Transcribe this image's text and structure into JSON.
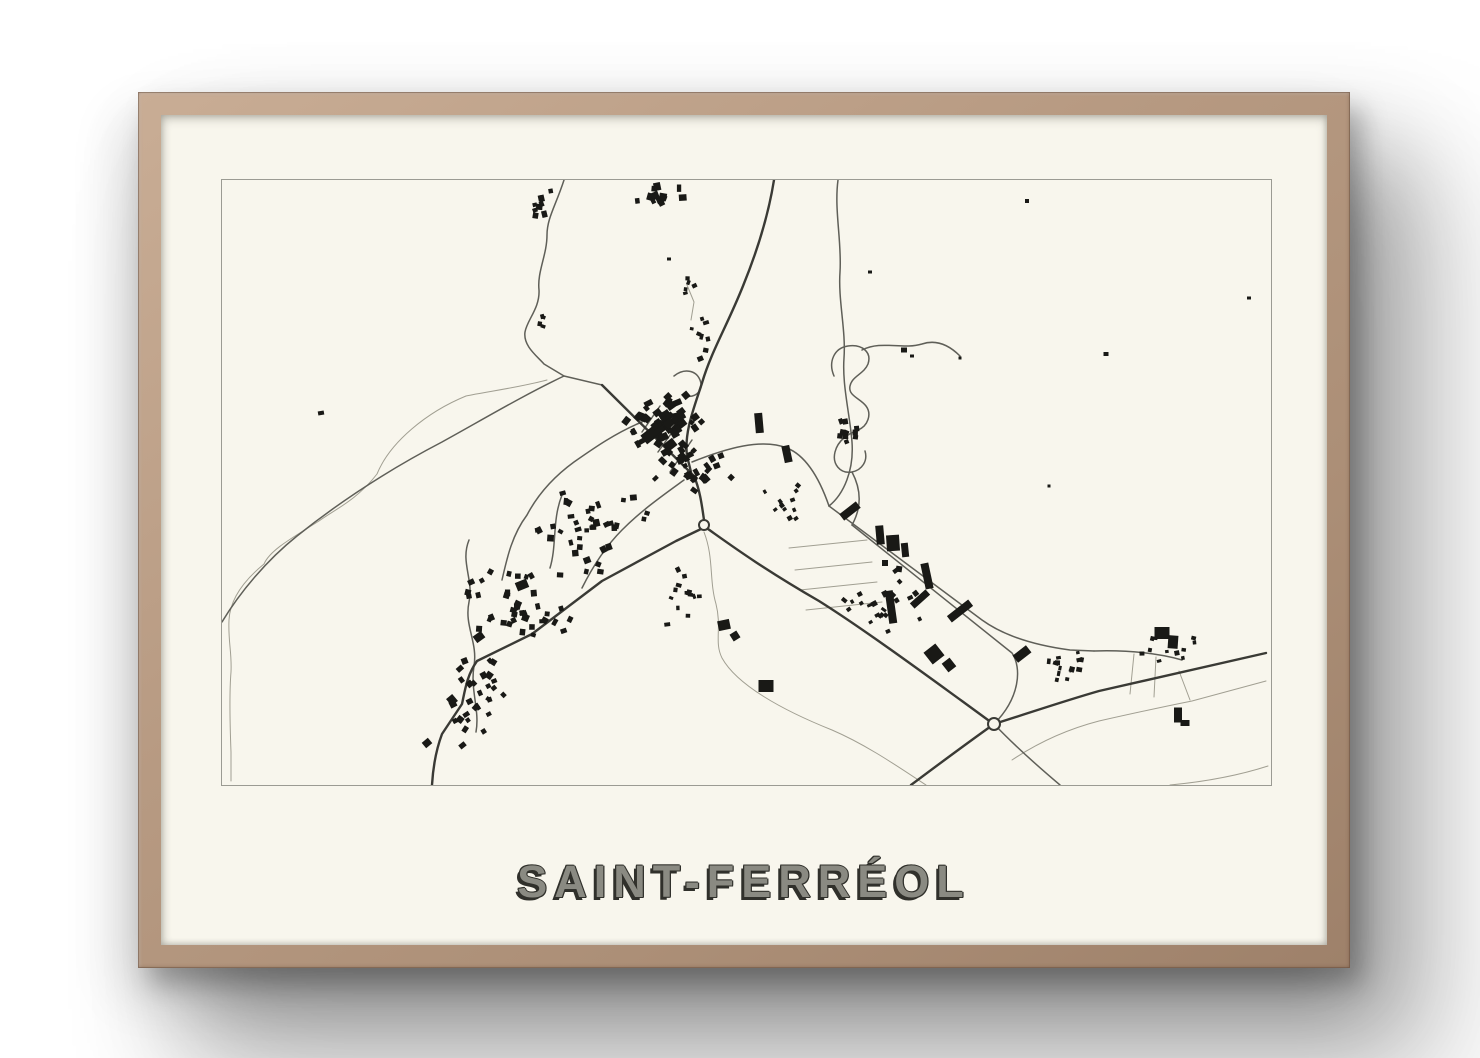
{
  "artwork": {
    "title": "SAINT-FERRÉOL",
    "type_label": "framed town map poster"
  },
  "frame": {
    "wood_light": "#c9ad95",
    "wood_mid": "#b2957e",
    "wood_dark": "#9e816a",
    "wall_color": "#ffffff"
  },
  "poster": {
    "paper_color": "#f8f6ed",
    "border_color": "#9b9b93",
    "ink_color": "#191916",
    "title_face_color": "#8a8a82",
    "title_shadow_color": "#30302b"
  },
  "map": {
    "place_name": "Saint-Ferréol",
    "road_styles": {
      "major": {
        "color": "#3a3a35",
        "width": 2.4
      },
      "minor": {
        "color": "#5f5f58",
        "width": 1.5
      },
      "trail": {
        "color": "#a19f92",
        "width": 1
      }
    },
    "roads": {
      "major": [
        "M552,0 C546,38 534,74 521,106 C505,146 489,172 480,203 C472,228 462,252 465,276 L469,292",
        "M380,205 L472,296 C478,310 480,326 482,340",
        "M479,349 L454,361 L380,401 L310,454 L255,481 C245,495 243,510 240,524 L220,554 C214,570 211,588 210,605",
        "M486,349 C510,366 540,388 597,421 C640,448 700,492 740,521 L766,540",
        "M689,605 C717,584 744,564 772,544 C807,533 842,521 877,511 C932,499 988,486 1044,473"
      ],
      "minor": [
        "M342,0 C334,25 325,38 325,55 C325,75 315,92 317,110 C318,128 305,140 303,152 C301,166 315,176 322,184 L342,196 L380,205",
        "M616,0 C612,30 620,62 618,92 C616,120 624,150 622,178 C620,205 628,235 630,262 C632,290 622,314 607,326",
        "M607,326 L760,440 C785,458 818,466 848,470 L872,471",
        "M630,345 L790,473 C800,488 798,518 772,544",
        "M470,282 C505,268 540,258 565,268 C585,276 598,300 607,326",
        "M612,196 C606,182 612,168 626,166 C640,164 650,172 646,184 C642,194 630,196 628,206 C626,216 638,218 644,226 C650,234 646,246 636,250 C626,254 616,260 613,272 C610,284 618,294 630,292 C640,290 646,281 643,271",
        "M630,292 C639,309 640,327 630,345",
        "M640,170 C660,160 680,170 700,164 C715,159 728,166 738,176",
        "M342,196 C300,216 260,240 220,262 C170,288 120,320 75,356 C45,380 18,412 0,442",
        "M420,242 C395,252 372,268 352,282 C330,298 315,316 305,335 C290,355 285,378 280,400",
        "M247,360 C238,382 252,400 247,422 C242,446 256,462 252,486 C248,510 258,530 254,552",
        "M340,315 C330,340 335,365 328,388",
        "M438,226 L420,252",
        "M456,244 L436,272",
        "M470,260 L448,292",
        "M452,196 C462,188 474,190 478,200 C482,210 474,218 464,216",
        "M462,300 C440,316 420,330 400,350 C382,368 370,388 360,408",
        "M772,544 C790,563 812,583 838,605",
        "M872,471 C905,470 935,473 960,480"
      ],
      "trail": [
        "M325,200 C295,208 262,212 244,216 C205,232 168,262 155,294 C135,320 112,330 97,341 C70,358 48,370 42,384 C20,402 8,420 7,440 C6,462 10,472 9,492 C7,516 8,546 9,572 L9,601",
        "M482,352 C492,378 487,400 494,424 C500,448 492,462 500,478 C515,505 560,530 610,550 C645,565 678,588 704,605",
        "M567,368 L645,360",
        "M573,390 L650,382",
        "M578,410 L655,402",
        "M584,430 L660,422",
        "M1046,586 C1015,596 980,602 948,605",
        "M790,580 C820,560 850,548 877,541 C908,534 940,527 970,521 L1044,501",
        "M957,491 L968,520",
        "M912,474 L908,514",
        "M934,477 L932,517",
        "M465,105 L472,122 L469,140"
      ]
    },
    "roundabouts": [
      [
        482,
        345,
        5
      ],
      [
        772,
        544,
        6
      ]
    ],
    "buildings_large": [
      [
        432,
        252,
        26,
        11,
        -38
      ],
      [
        448,
        265,
        12,
        9,
        -38
      ],
      [
        456,
        240,
        9,
        15,
        -12
      ],
      [
        420,
        237,
        10,
        8,
        22
      ],
      [
        537,
        243,
        8,
        20,
        -5
      ],
      [
        565,
        274,
        8,
        17,
        -12
      ],
      [
        628,
        331,
        21,
        8,
        -38
      ],
      [
        658,
        355,
        8,
        19,
        -5
      ],
      [
        671,
        363,
        13,
        16,
        -4
      ],
      [
        683,
        370,
        7,
        14,
        -6
      ],
      [
        663,
        383,
        6,
        6,
        0
      ],
      [
        677,
        389,
        6,
        6,
        8
      ],
      [
        705,
        396,
        8,
        26,
        -12
      ],
      [
        698,
        419,
        21,
        7,
        -42
      ],
      [
        738,
        431,
        27,
        8,
        -38
      ],
      [
        669,
        427,
        8,
        33,
        -8
      ],
      [
        712,
        474,
        15,
        15,
        -38
      ],
      [
        727,
        485,
        10,
        11,
        -38
      ],
      [
        800,
        474,
        17,
        9,
        -38
      ],
      [
        940,
        453,
        15,
        12,
        0
      ],
      [
        951,
        462,
        10,
        13,
        4
      ],
      [
        956,
        535,
        8,
        15,
        0
      ],
      [
        963,
        543,
        9,
        6,
        0
      ],
      [
        502,
        445,
        12,
        10,
        -12
      ],
      [
        513,
        456,
        8,
        8,
        -32
      ],
      [
        544,
        506,
        15,
        12,
        0
      ],
      [
        300,
        405,
        12,
        9,
        -22
      ],
      [
        257,
        457,
        10,
        8,
        -36
      ],
      [
        230,
        520,
        8,
        9,
        -40
      ],
      [
        205,
        563,
        8,
        7,
        -40
      ]
    ],
    "buildings_single": [
      [
        99,
        233,
        6,
        4,
        -10
      ],
      [
        682,
        170,
        6,
        5,
        0
      ],
      [
        805,
        21,
        4,
        4,
        0
      ],
      [
        884,
        174,
        5,
        4,
        0
      ],
      [
        1027,
        118,
        4,
        3,
        0
      ],
      [
        827,
        306,
        3,
        3,
        0
      ],
      [
        738,
        178,
        3,
        3,
        0
      ],
      [
        690,
        176,
        4,
        3,
        0
      ],
      [
        648,
        92,
        4,
        3,
        0
      ],
      [
        447,
        79,
        4,
        3,
        0
      ]
    ],
    "building_clusters": [
      {
        "cx": 437,
        "cy": 17,
        "rx": 30,
        "ry": 15,
        "count": 13,
        "min": 4,
        "max": 8,
        "angle": 0,
        "jitter": 60,
        "seed": 11
      },
      {
        "cx": 322,
        "cy": 32,
        "rx": 16,
        "ry": 24,
        "count": 9,
        "min": 4,
        "max": 7,
        "angle": -10,
        "jitter": 50,
        "seed": 22
      },
      {
        "cx": 318,
        "cy": 142,
        "rx": 8,
        "ry": 15,
        "count": 4,
        "min": 3,
        "max": 5,
        "angle": 0,
        "jitter": 60,
        "seed": 33
      },
      {
        "cx": 443,
        "cy": 243,
        "rx": 46,
        "ry": 36,
        "count": 42,
        "min": 4,
        "max": 9,
        "angle": -38,
        "jitter": 30,
        "seed": 44
      },
      {
        "cx": 468,
        "cy": 288,
        "rx": 44,
        "ry": 28,
        "count": 30,
        "min": 4,
        "max": 8,
        "angle": -38,
        "jitter": 35,
        "seed": 55
      },
      {
        "cx": 373,
        "cy": 352,
        "rx": 66,
        "ry": 42,
        "count": 38,
        "min": 4,
        "max": 7,
        "angle": 0,
        "jitter": 60,
        "seed": 66
      },
      {
        "cx": 303,
        "cy": 430,
        "rx": 66,
        "ry": 48,
        "count": 40,
        "min": 4,
        "max": 7,
        "angle": 0,
        "jitter": 60,
        "seed": 77
      },
      {
        "cx": 253,
        "cy": 520,
        "rx": 36,
        "ry": 52,
        "count": 28,
        "min": 4,
        "max": 7,
        "angle": -40,
        "jitter": 40,
        "seed": 88
      },
      {
        "cx": 658,
        "cy": 420,
        "rx": 56,
        "ry": 42,
        "count": 22,
        "min": 3,
        "max": 6,
        "angle": -38,
        "jitter": 30,
        "seed": 99
      },
      {
        "cx": 838,
        "cy": 487,
        "rx": 30,
        "ry": 22,
        "count": 14,
        "min": 3,
        "max": 6,
        "angle": 0,
        "jitter": 50,
        "seed": 110
      },
      {
        "cx": 945,
        "cy": 470,
        "rx": 36,
        "ry": 18,
        "count": 11,
        "min": 3,
        "max": 5,
        "angle": 0,
        "jitter": 40,
        "seed": 121
      },
      {
        "cx": 627,
        "cy": 240,
        "rx": 19,
        "ry": 33,
        "count": 10,
        "min": 4,
        "max": 6,
        "angle": 0,
        "jitter": 50,
        "seed": 132
      },
      {
        "cx": 481,
        "cy": 160,
        "rx": 14,
        "ry": 36,
        "count": 8,
        "min": 3,
        "max": 6,
        "angle": 0,
        "jitter": 50,
        "seed": 143
      },
      {
        "cx": 558,
        "cy": 328,
        "rx": 36,
        "ry": 25,
        "count": 12,
        "min": 3,
        "max": 5,
        "angle": -30,
        "jitter": 40,
        "seed": 154
      },
      {
        "cx": 468,
        "cy": 420,
        "rx": 27,
        "ry": 37,
        "count": 13,
        "min": 3,
        "max": 6,
        "angle": 0,
        "jitter": 50,
        "seed": 165
      },
      {
        "cx": 467,
        "cy": 112,
        "rx": 10,
        "ry": 17,
        "count": 5,
        "min": 3,
        "max": 5,
        "angle": 0,
        "jitter": 50,
        "seed": 176
      }
    ]
  }
}
